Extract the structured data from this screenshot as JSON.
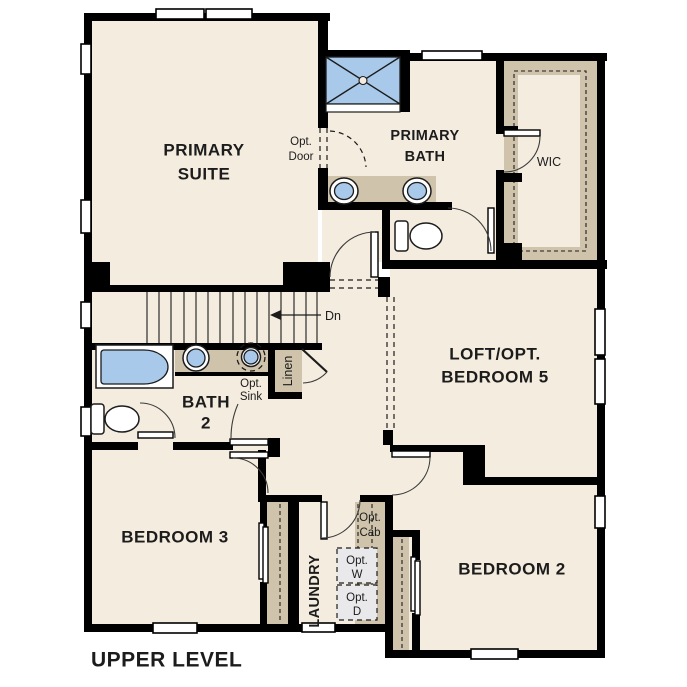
{
  "title": "UPPER LEVEL",
  "rooms": {
    "primary_suite": {
      "line1": "PRIMARY",
      "line2": "SUITE"
    },
    "primary_bath": {
      "line1": "PRIMARY",
      "line2": "BATH"
    },
    "wic": {
      "label": "WIC"
    },
    "loft": {
      "line1": "LOFT/OPT.",
      "line2": "BEDROOM 5"
    },
    "bath2": {
      "line1": "BATH",
      "line2": "2"
    },
    "bedroom3": {
      "label": "BEDROOM 3"
    },
    "bedroom2": {
      "label": "BEDROOM 2"
    },
    "laundry": {
      "label": "LAUNDRY"
    },
    "linen": {
      "label": "Linen"
    }
  },
  "annotations": {
    "opt_door": {
      "line1": "Opt.",
      "line2": "Door"
    },
    "opt_sink": {
      "line1": "Opt.",
      "line2": "Sink"
    },
    "opt_cab": {
      "line1": "Opt.",
      "line2": "Cab"
    },
    "opt_washer": {
      "line1": "Opt.",
      "line2": "W"
    },
    "opt_dryer": {
      "line1": "Opt.",
      "line2": "D"
    },
    "stairs_down": "Dn"
  },
  "colors": {
    "wall": "#000000",
    "floor": "#f4ecdf",
    "outside": "#ffffff",
    "cabinetry": "#cfc3ab",
    "fixture_blue": "#a8c9e9",
    "appliance_gray": "#e9e9ec",
    "linework": "#3c3c3c",
    "text": "#1c1c1c"
  }
}
